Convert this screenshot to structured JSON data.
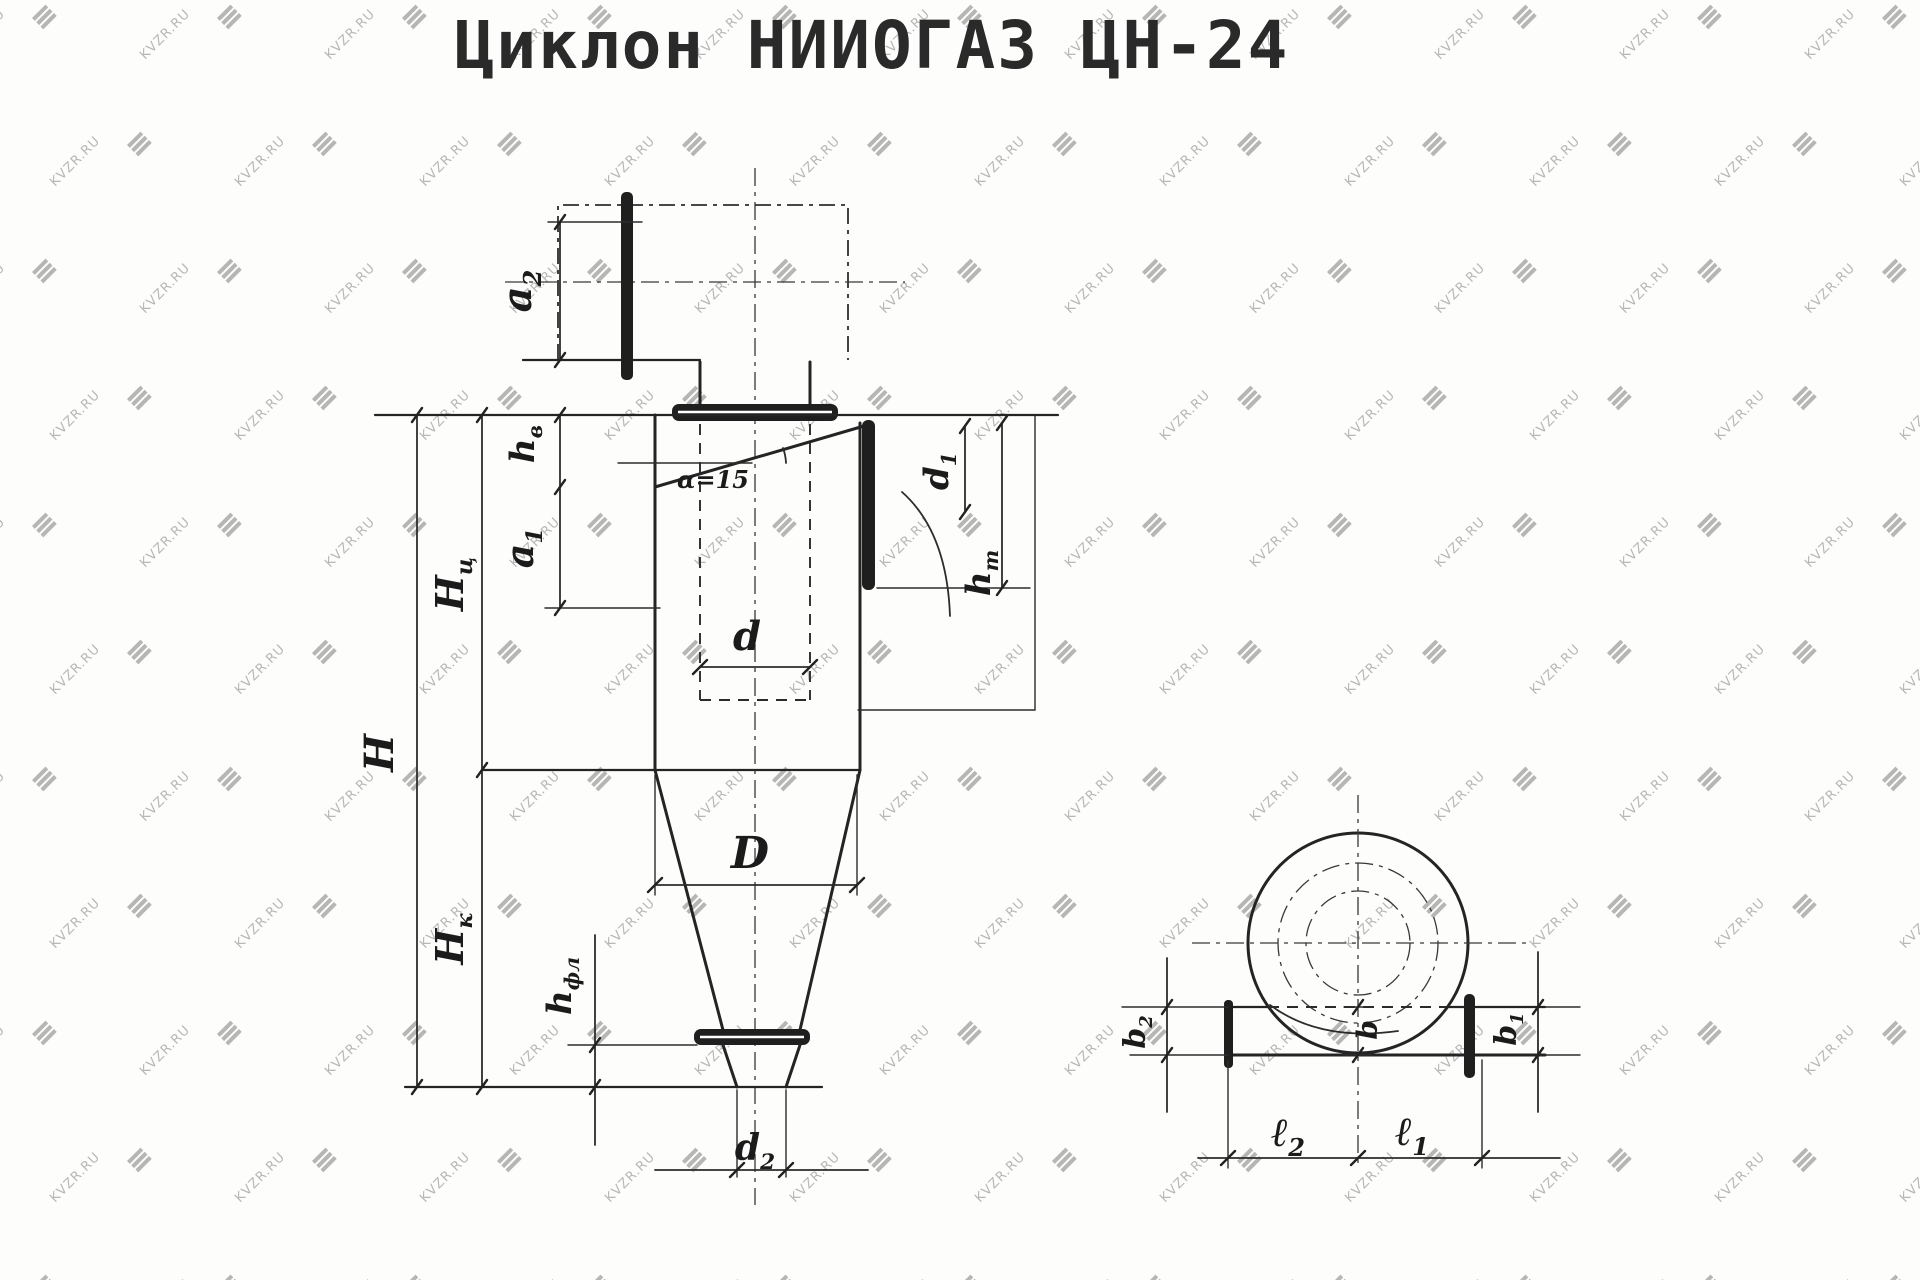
{
  "title": "Циклон НИИОГАЗ ЦН-24",
  "watermark": {
    "text": "KVZR.RU"
  },
  "side_view": {
    "labels": {
      "a2": {
        "main": "a",
        "sub": "2"
      },
      "hv": {
        "main": "h",
        "sub": "в"
      },
      "a1": {
        "main": "a",
        "sub": "1"
      },
      "Hc": {
        "main": "Н",
        "sub": "ц"
      },
      "H": {
        "main": "Н",
        "sub": ""
      },
      "Hk": {
        "main": "Н",
        "sub": "к"
      },
      "hfl": {
        "main": "h",
        "sub": "фл"
      },
      "d": {
        "main": "d",
        "sub": ""
      },
      "D": {
        "main": "D",
        "sub": ""
      },
      "d1": {
        "main": "d",
        "sub": "1"
      },
      "ht": {
        "main": "h",
        "sub": "т"
      },
      "alpha": {
        "main": "α=15",
        "sub": ""
      },
      "d2": {
        "main": "d",
        "sub": "2"
      }
    }
  },
  "top_view": {
    "labels": {
      "b2": {
        "main": "b",
        "sub": "2"
      },
      "b1": {
        "main": "b",
        "sub": "1"
      },
      "b": {
        "main": "b",
        "sub": ""
      },
      "l2": {
        "main": "ℓ",
        "sub": "2"
      },
      "l1": {
        "main": "ℓ",
        "sub": "1"
      }
    }
  }
}
